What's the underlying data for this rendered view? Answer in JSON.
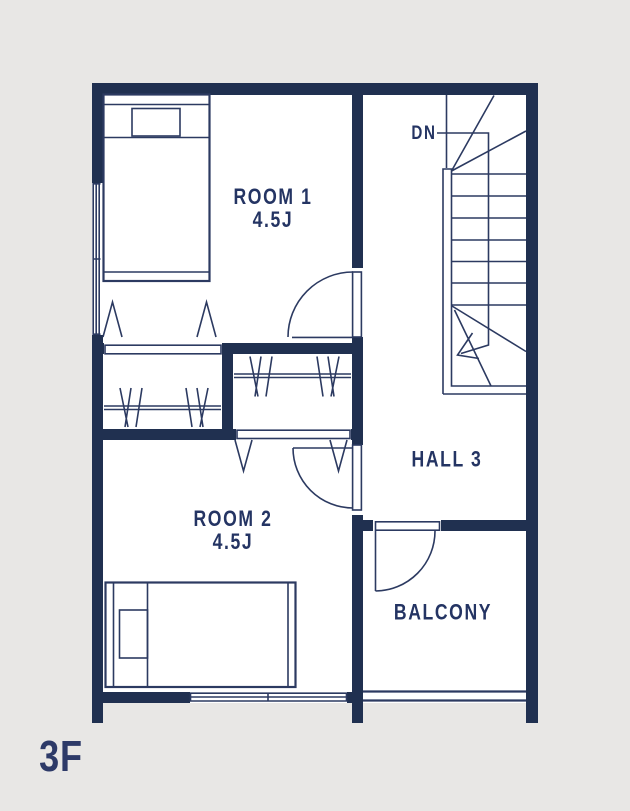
{
  "floor_label": "3F",
  "rooms": [
    {
      "name": "ROOM 1",
      "size": "4.5J"
    },
    {
      "name": "ROOM 2",
      "size": "4.5J"
    }
  ],
  "hall": {
    "name": "HALL 3"
  },
  "balcony": {
    "name": "BALCONY"
  },
  "stairs": {
    "direction_label": "DN"
  },
  "colors": {
    "background": "#e8e7e5",
    "floor": "#ffffff",
    "wall": "#203050",
    "line": "#2c3a61",
    "label": "#243463",
    "floor_label_color": "#2d3a68"
  }
}
